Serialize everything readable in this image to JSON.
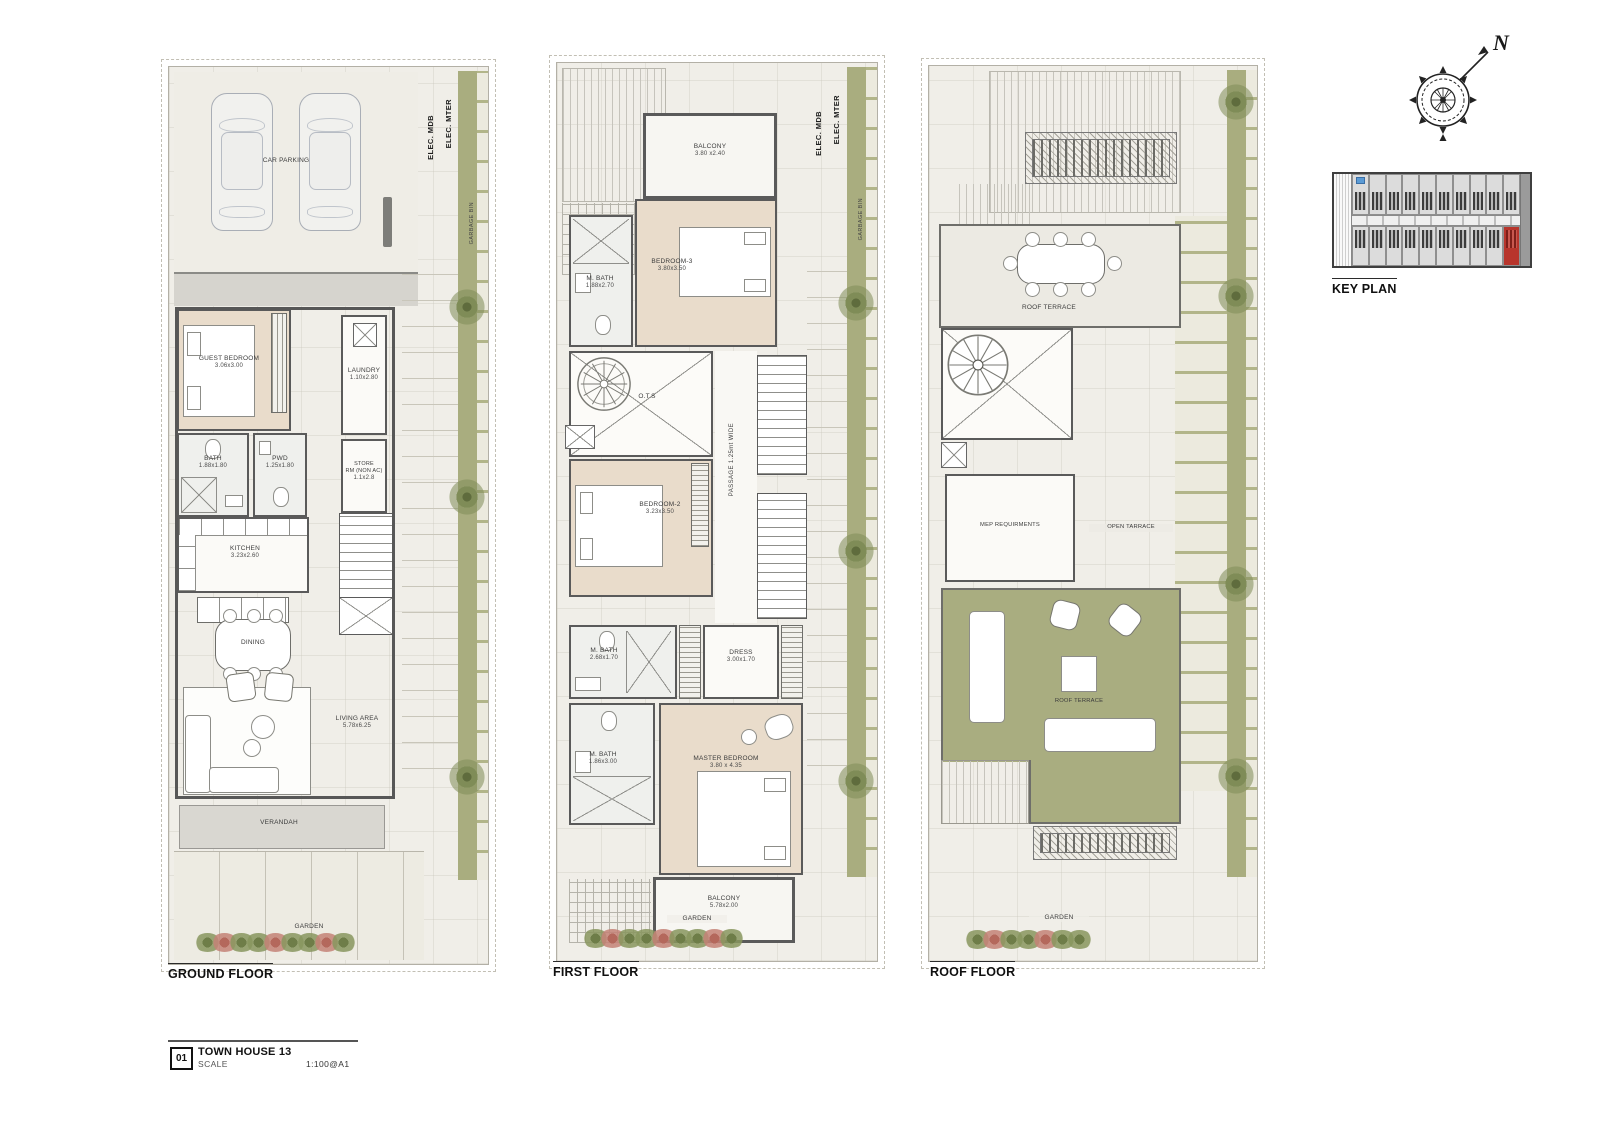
{
  "compass": {
    "north": "N"
  },
  "key_plan": {
    "title": "KEY PLAN"
  },
  "title_block": {
    "number": "01",
    "name": "TOWN HOUSE 13",
    "scale_label": "SCALE",
    "scale_value": "1:100@A1"
  },
  "floors": {
    "ground": {
      "title": "GROUND FLOOR",
      "car_parking": "CAR PARKING",
      "elec_mdb": "ELEC. MDB",
      "elec_mter": "ELEC. MTER",
      "garbage": "GARBAGE BIN",
      "guest_bedroom": {
        "name": "GUEST BEDROOM",
        "dim": "3.06x3.00"
      },
      "laundry": {
        "name": "LAUNDRY",
        "dim": "1.10x2.80"
      },
      "bath": {
        "name": "BATH",
        "dim": "1.88x1.80"
      },
      "pwd": {
        "name": "PWD",
        "dim": "1.25x1.80"
      },
      "store": {
        "name": "STORE",
        "name2": "RM (NON AC)",
        "dim": "1.1x2.8"
      },
      "kitchen": {
        "name": "KITCHEN",
        "dim": "3.23x2.60"
      },
      "dining": {
        "name": "DINING"
      },
      "living": {
        "name": "LIVING AREA",
        "dim": "5.78x6.25"
      },
      "verandah": "VERANDAH",
      "up": "UP",
      "garden": "GARDEN"
    },
    "first": {
      "title": "FIRST FLOOR",
      "elec_mdb": "ELEC. MDB",
      "elec_mter": "ELEC. MTER",
      "garbage": "GARBAGE BIN",
      "balcony_top": {
        "name": "BALCONY",
        "dim": "3.80 x2.40"
      },
      "bedroom3": {
        "name": "BEDROOM-3",
        "dim": "3.80x3.50"
      },
      "mbath3": {
        "name": "M. BATH",
        "dim": "1.88x2.70"
      },
      "ots": {
        "name": "O.T.S"
      },
      "passage": {
        "name": "PASSAGE 1.25mt WIDE"
      },
      "bedroom2": {
        "name": "BEDROOM-2",
        "dim": "3.23x3.50"
      },
      "mbath2": {
        "name": "M. BATH",
        "dim": "2.68x1.70"
      },
      "dress": {
        "name": "DRESS",
        "dim": "3.00x1.70"
      },
      "mbath_master": {
        "name": "M. BATH",
        "dim": "1.86x3.00"
      },
      "master_bedroom": {
        "name": "MASTER BEDROOM",
        "dim": "3.80 x 4.35"
      },
      "balcony_bottom": {
        "name": "BALCONY",
        "dim": "5.78x2.00"
      },
      "garden": "GARDEN"
    },
    "roof": {
      "title": "ROOF FLOOR",
      "terrace_top": {
        "name": "ROOF TERRACE"
      },
      "mep": {
        "name": "MEP REQUIRMENTS"
      },
      "open_terrace": {
        "name": "OPEN TARRACE"
      },
      "terrace_lounge": {
        "name": "ROOF TERRACE"
      },
      "garden": "GARDEN"
    }
  }
}
